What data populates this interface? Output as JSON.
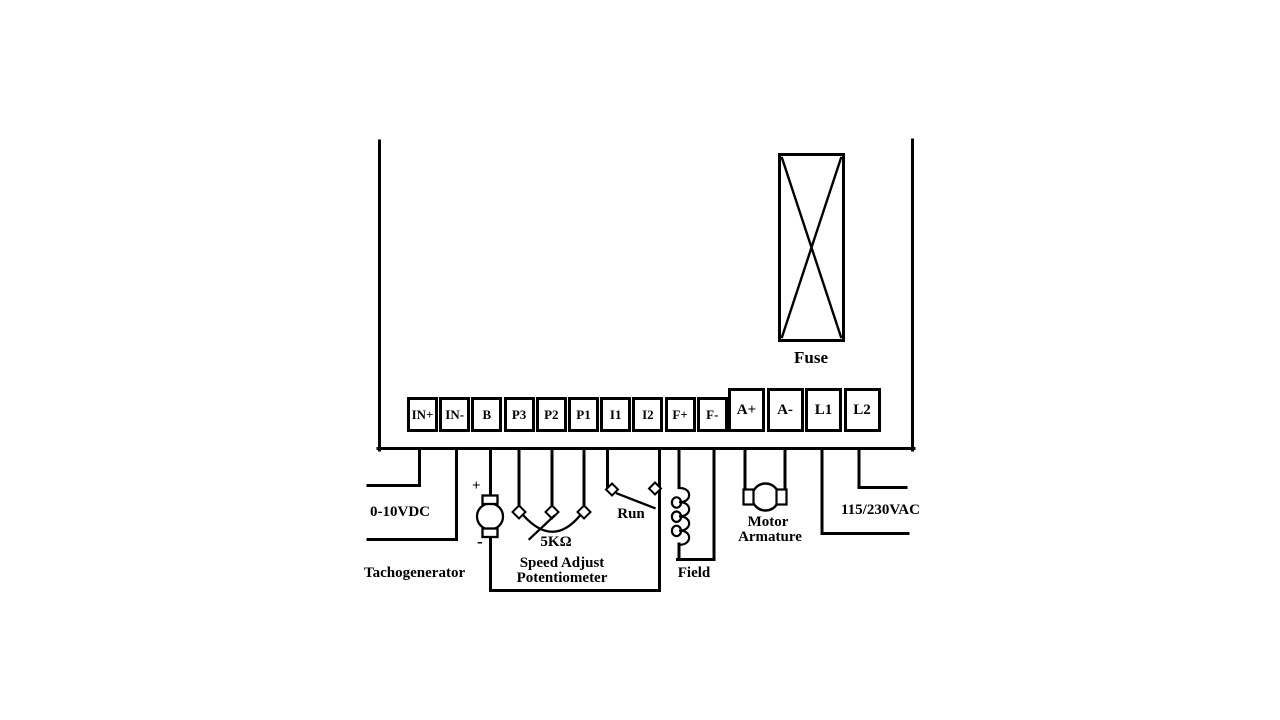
{
  "diagram_title": "DC drive terminal wiring diagram",
  "colors": {
    "line": "#000000",
    "background": "#ffffff"
  },
  "controller": {
    "terminals": [
      "IN+",
      "IN-",
      "B",
      "P3",
      "P2",
      "P1",
      "I1",
      "I2",
      "F+",
      "F-",
      "A+",
      "A-",
      "L1",
      "L2"
    ]
  },
  "labels": {
    "fuse": "Fuse",
    "input_voltage": "0-10VDC",
    "tachogenerator": "Tachogenerator",
    "tach_plus": "+",
    "tach_minus": "-",
    "pot_value": "5KΩ",
    "pot_line1": "Speed Adjust",
    "pot_line2": "Potentiometer",
    "run_switch": "Run",
    "field": "Field",
    "motor_line1": "Motor",
    "motor_line2": "Armature",
    "line_voltage": "115/230VAC"
  }
}
